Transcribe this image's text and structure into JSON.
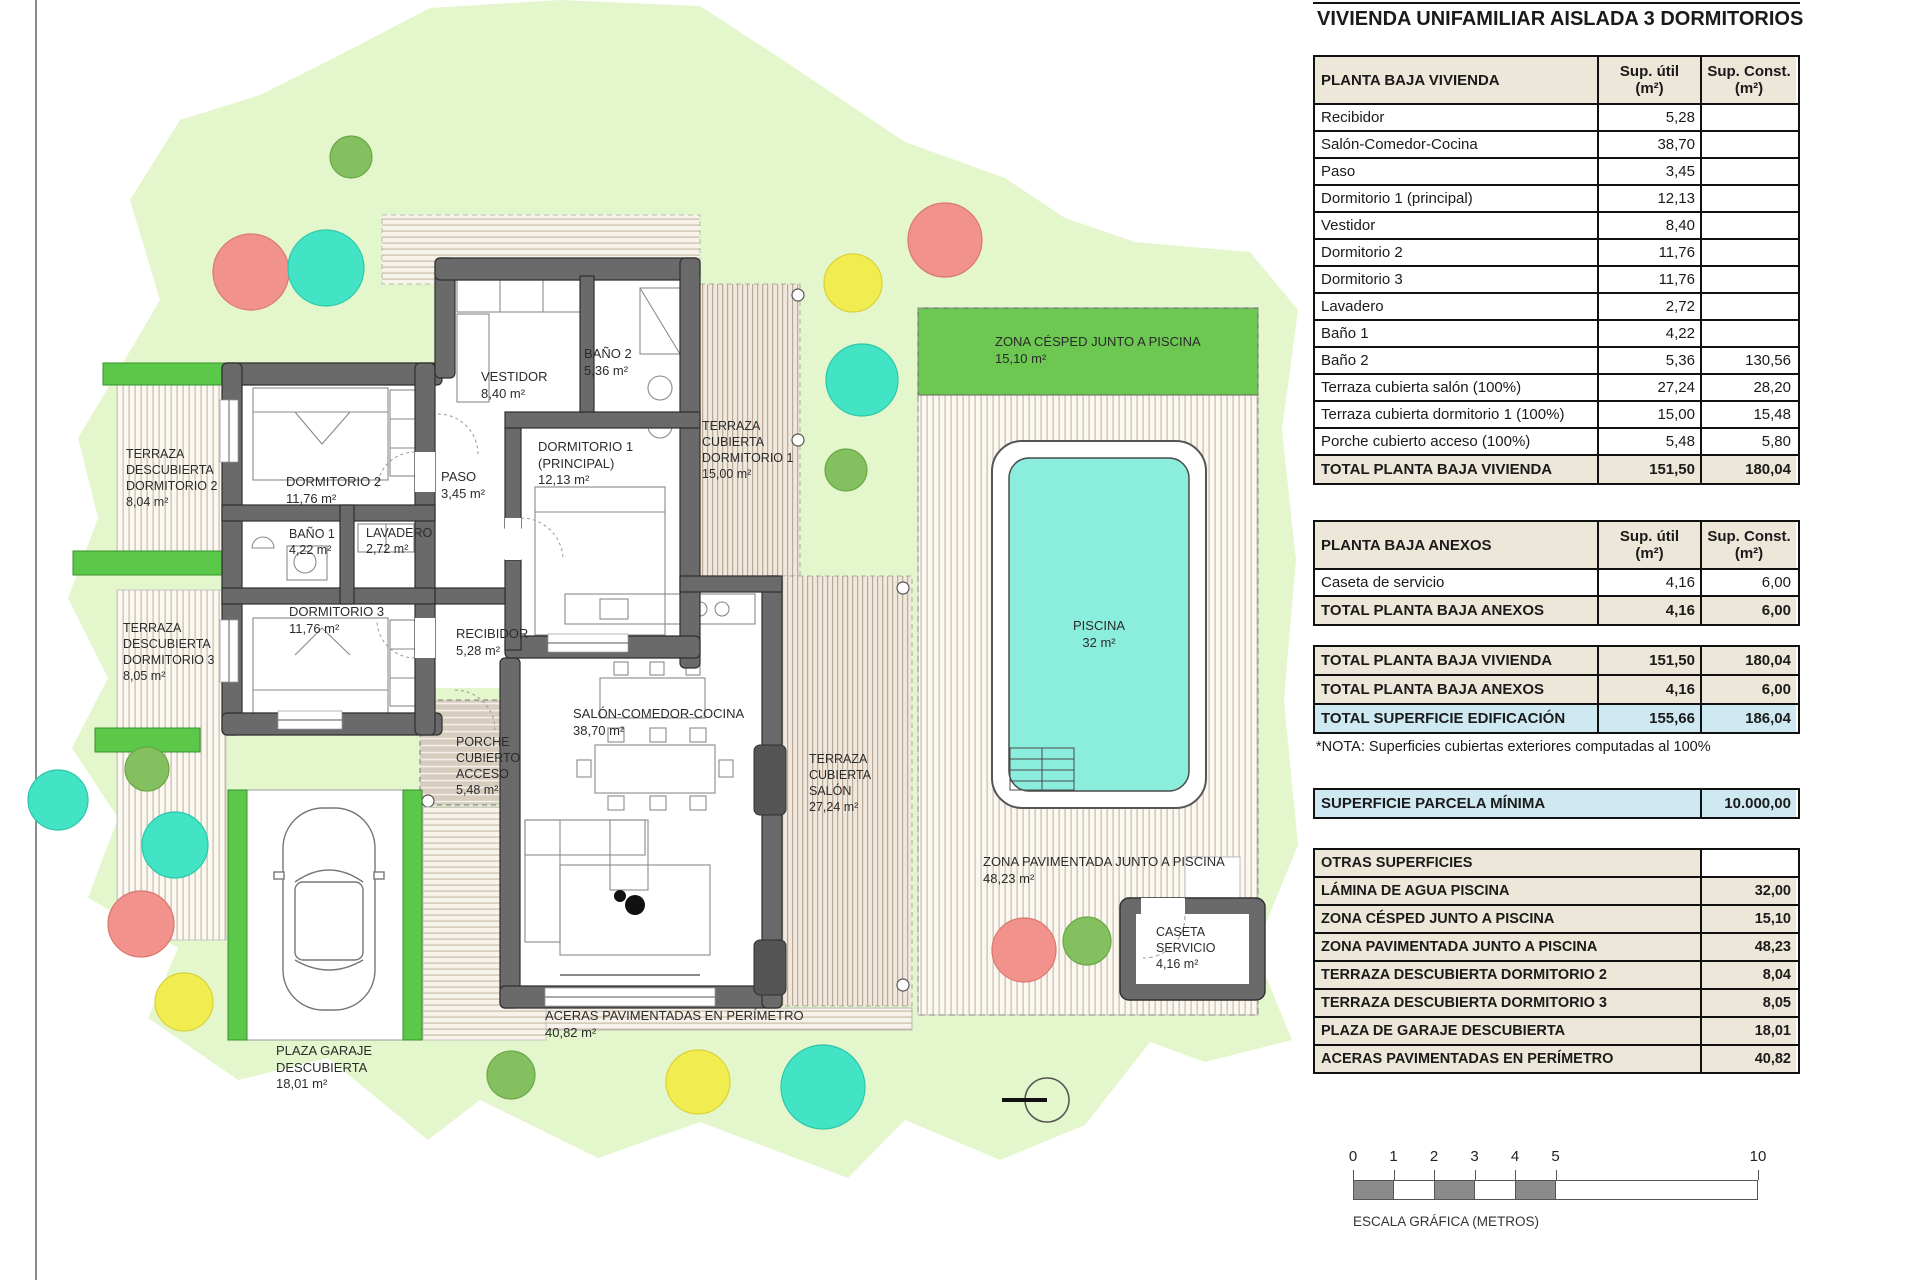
{
  "title": "VIVIENDA UNIFAMILIAR AISLADA 3 DORMITORIOS",
  "colors": {
    "header_tan": "#EDE7D9",
    "highlight_blue": "#CFE9F3",
    "site_green": "#E4F6CC",
    "hedge_green": "#5BC84A",
    "lawn_band_green": "#6CC851",
    "pool_cyan": "#8BEEDC",
    "wall_gray": "#6A6A6A",
    "tree_red": "#F2928C",
    "tree_teal": "#43E4C5",
    "tree_yellow": "#F1EC4F",
    "tree_green": "#84C05F"
  },
  "tables": {
    "planta_baja_vivienda": {
      "header": [
        "PLANTA BAJA VIVIENDA",
        [
          "Sup. útil",
          "(m²)"
        ],
        [
          "Sup. Const.",
          "(m²)"
        ]
      ],
      "rows": [
        [
          "Recibidor",
          "5,28",
          ""
        ],
        [
          "Salón-Comedor-Cocina",
          "38,70",
          ""
        ],
        [
          "Paso",
          "3,45",
          ""
        ],
        [
          "Dormitorio 1 (principal)",
          "12,13",
          ""
        ],
        [
          "Vestidor",
          "8,40",
          ""
        ],
        [
          "Dormitorio 2",
          "11,76",
          ""
        ],
        [
          "Dormitorio 3",
          "11,76",
          ""
        ],
        [
          "Lavadero",
          "2,72",
          ""
        ],
        [
          "Baño 1",
          "4,22",
          ""
        ],
        [
          "Baño 2",
          "5,36",
          "130,56"
        ],
        [
          "Terraza cubierta salón (100%)",
          "27,24",
          "28,20"
        ],
        [
          "Terraza cubierta dormitorio 1 (100%)",
          "15,00",
          "15,48"
        ],
        [
          "Porche cubierto acceso (100%)",
          "5,48",
          "5,80"
        ]
      ],
      "total": [
        "TOTAL PLANTA BAJA VIVIENDA",
        "151,50",
        "180,04"
      ]
    },
    "planta_baja_anexos": {
      "header": [
        "PLANTA BAJA ANEXOS",
        [
          "Sup. útil",
          "(m²)"
        ],
        [
          "Sup. Const.",
          "(m²)"
        ]
      ],
      "rows": [
        [
          "Caseta de servicio",
          "4,16",
          "6,00"
        ]
      ],
      "total": [
        "TOTAL PLANTA BAJA ANEXOS",
        "4,16",
        "6,00"
      ]
    },
    "resumen": {
      "rows": [
        {
          "cells": [
            "TOTAL PLANTA BAJA VIVIENDA",
            "151,50",
            "180,04"
          ],
          "style": "tan"
        },
        {
          "cells": [
            "TOTAL PLANTA BAJA ANEXOS",
            "4,16",
            "6,00"
          ],
          "style": "tan"
        },
        {
          "cells": [
            "TOTAL SUPERFICIE EDIFICACIÓN",
            "155,66",
            "186,04"
          ],
          "style": "blue"
        }
      ]
    },
    "nota": "*NOTA: Superficies cubiertas exteriores computadas al 100%",
    "parcela": {
      "label": "SUPERFICIE PARCELA MÍNIMA",
      "value": "10.000,00"
    },
    "otras_superficies": {
      "header": "OTRAS SUPERFICIES",
      "rows": [
        [
          "LÁMINA DE AGUA PISCINA",
          "32,00"
        ],
        [
          "ZONA CÉSPED JUNTO A PISCINA",
          "15,10"
        ],
        [
          "ZONA PAVIMENTADA JUNTO A PISCINA",
          "48,23"
        ],
        [
          "TERRAZA DESCUBIERTA DORMITORIO 2",
          "8,04"
        ],
        [
          "TERRAZA DESCUBIERTA DORMITORIO 3",
          "8,05"
        ],
        [
          "PLAZA DE GARAJE DESCUBIERTA",
          "18,01"
        ],
        [
          "ACERAS PAVIMENTADAS EN PERÍMETRO",
          "40,82"
        ]
      ]
    }
  },
  "scale_bar": {
    "ticks": [
      {
        "label": "0",
        "m": 0
      },
      {
        "label": "1",
        "m": 1
      },
      {
        "label": "2",
        "m": 2
      },
      {
        "label": "3",
        "m": 3
      },
      {
        "label": "4",
        "m": 4
      },
      {
        "label": "5",
        "m": 5
      },
      {
        "label": "10",
        "m": 10
      }
    ],
    "label": "ESCALA GRÁFICA (METROS)"
  },
  "plan": {
    "labels": {
      "terraza_d2": [
        "TERRAZA",
        "DESCUBIERTA",
        "DORMITORIO 2",
        "8,04 m²"
      ],
      "terraza_d3": [
        "TERRAZA",
        "DESCUBIERTA",
        "DORMITORIO 3",
        "8,05 m²"
      ],
      "dorm2": [
        "DORMITORIO 2",
        "11,76 m²"
      ],
      "bano1": [
        "BAÑO 1",
        "4,22 m²"
      ],
      "lavadero": [
        "LAVADERO",
        "2,72 m²"
      ],
      "dorm3": [
        "DORMITORIO 3",
        "11,76 m²"
      ],
      "paso": [
        "PASO",
        "3,45 m²"
      ],
      "recibidor": [
        "RECIBIDOR",
        "5,28 m²"
      ],
      "vestidor": [
        "VESTIDOR",
        "8,40 m²"
      ],
      "bano2": [
        "BAÑO 2",
        "5,36 m²"
      ],
      "dorm1": [
        "DORMITORIO 1",
        "(PRINCIPAL)",
        "12,13 m²"
      ],
      "terraza_cub_dorm1": [
        "TERRAZA",
        "CUBIERTA",
        "DORMITORIO 1",
        "15,00 m²"
      ],
      "porche": [
        "PORCHE",
        "CUBIERTO",
        "ACCESO",
        "5,48 m²"
      ],
      "salon": [
        "SALÓN-COMEDOR-COCINA",
        "38,70 m²"
      ],
      "terraza_cub_salon": [
        "TERRAZA",
        "CUBIERTA",
        "SALÓN",
        "27,24 m²"
      ],
      "aceras": [
        "ACERAS PAVIMENTADAS EN PERÍMETRO",
        "40,82 m²"
      ],
      "cesped": [
        "ZONA CÉSPED JUNTO A PISCINA",
        "15,10 m²"
      ],
      "piscina": [
        "PISCINA",
        "32 m²"
      ],
      "zona_pavimentada": [
        "ZONA PAVIMENTADA JUNTO A PISCINA",
        "48,23 m²"
      ],
      "caseta": [
        "CASETA",
        "SERVICIO",
        "4,16 m²"
      ],
      "garaje": [
        "PLAZA GARAJE",
        "DESCUBIERTA",
        "18,01 m²"
      ]
    }
  }
}
